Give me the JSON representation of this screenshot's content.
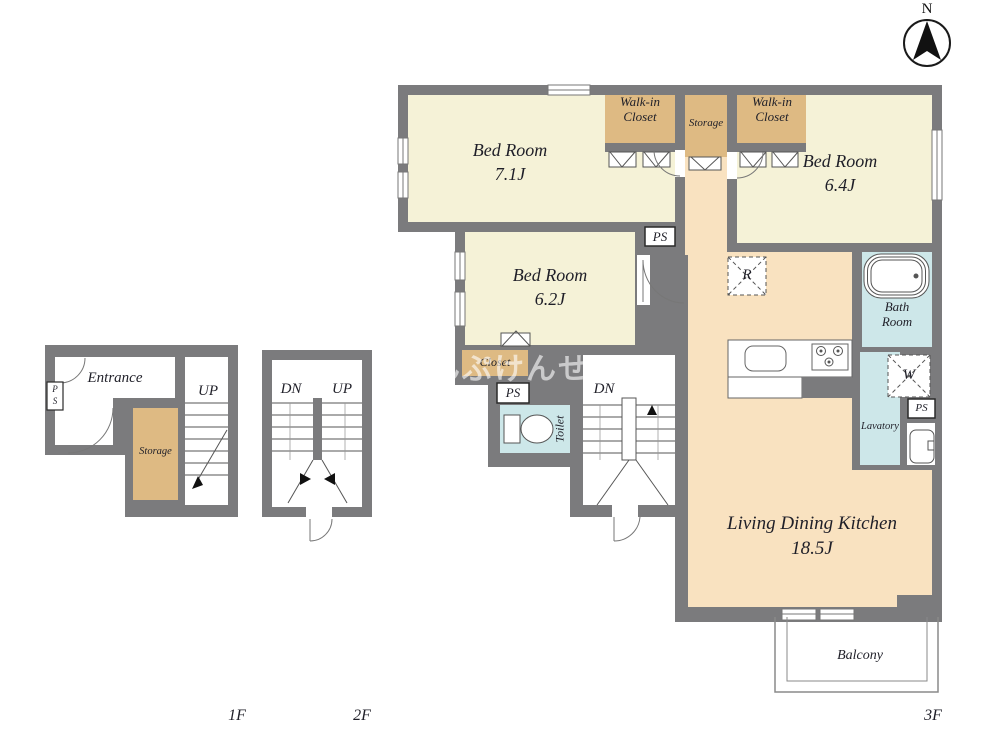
{
  "compass": {
    "north": "N"
  },
  "watermark": "さんぷけんせつ",
  "floor_labels": {
    "f1": "1F",
    "f2": "2F",
    "f3": "3F"
  },
  "rooms": {
    "bed1_name": "Bed Room",
    "bed1_size": "7.1J",
    "bed2_name": "Bed Room",
    "bed2_size": "6.4J",
    "bed3_name": "Bed Room",
    "bed3_size": "6.2J",
    "ldk_name": "Living Dining Kitchen",
    "ldk_size": "18.5J",
    "wic_line1": "Walk-in",
    "wic_line2": "Closet",
    "storage": "Storage",
    "bath_line1": "Bath",
    "bath_line2": "Room",
    "lavatory": "Lavatory",
    "toilet": "Toilet",
    "closet": "Closet",
    "balcony": "Balcony",
    "entrance": "Entrance"
  },
  "markers": {
    "ps": "PS",
    "r": "R",
    "w": "W",
    "dn": "DN",
    "up": "UP",
    "p": "P",
    "s": "S"
  },
  "colors": {
    "wall": "#7b7b7d",
    "room_cream": "#f5f2d7",
    "closet_tan": "#deba83",
    "ldk_peach": "#f9e2c0",
    "wet_blue": "#cde7e9"
  }
}
